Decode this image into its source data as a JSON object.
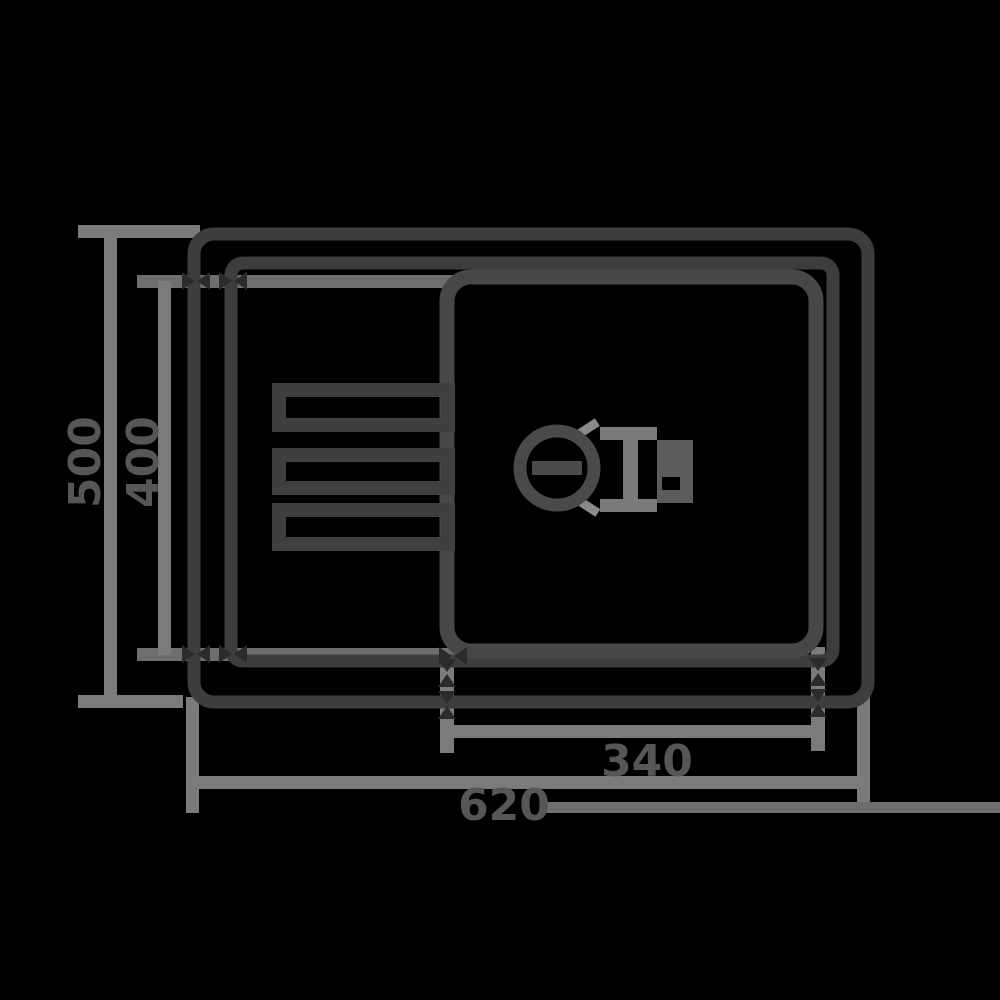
{
  "diagram": {
    "type": "technical-drawing",
    "subject": "kitchen sink with drainboard - top view dimension drawing",
    "labels": {
      "overall_width": "620",
      "bowl_width": "340",
      "overall_depth": "500",
      "bowl_depth": "400"
    },
    "colors": {
      "background": "#000000",
      "outline_dark": "#3d3d3d",
      "bowl_outline": "#474747",
      "ridge_outline": "#3f3f3f",
      "drain_outline": "#4a4a4a",
      "fitting_gray": "#7a7a7a",
      "fitting_fill": "#5c5c5c",
      "dimension_line": "#7b7b7b",
      "extension_line": "#6e6e6e",
      "arrow_marker": "#2b2b2b",
      "label_text": "#565656",
      "highlight_arc": "#8a8a8a"
    }
  }
}
